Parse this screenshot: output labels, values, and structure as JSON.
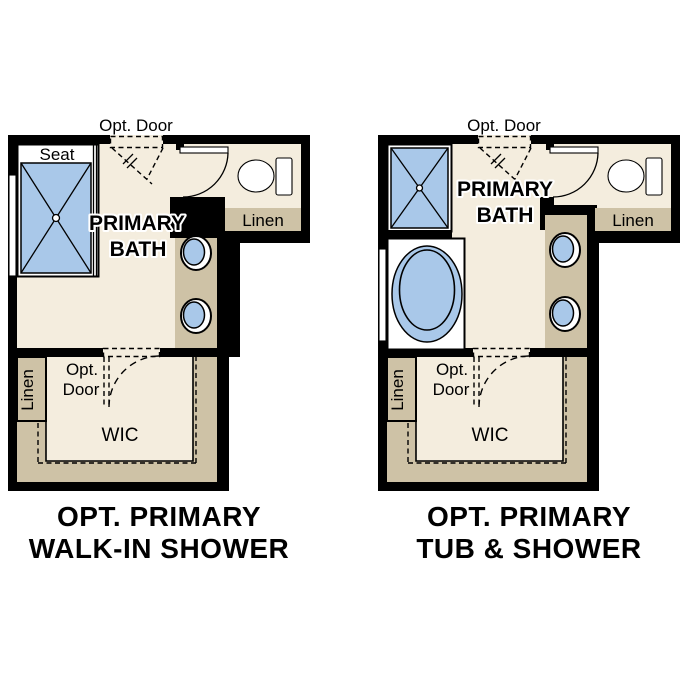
{
  "colors": {
    "wall": "#000000",
    "floor": "#f4edde",
    "cabinet": "#cec2a6",
    "fixture": "#a9c8e9",
    "white": "#ffffff",
    "text": "#000000"
  },
  "labels": {
    "opt_door_top": "Opt. Door",
    "seat": "Seat",
    "primary_line1": "PRIMARY",
    "primary_line2": "BATH",
    "linen_bath": "Linen",
    "linen_wic": "Linen",
    "opt": "Opt.",
    "door": "Door",
    "wic": "WIC"
  },
  "plans": [
    {
      "id": "opt-primary-walk-in-shower",
      "caption_line1": "OPT. PRIMARY",
      "caption_line2": "WALK-IN SHOWER"
    },
    {
      "id": "opt-primary-tub-and-shower",
      "caption_line1": "OPT. PRIMARY",
      "caption_line2": "TUB & SHOWER"
    }
  ]
}
